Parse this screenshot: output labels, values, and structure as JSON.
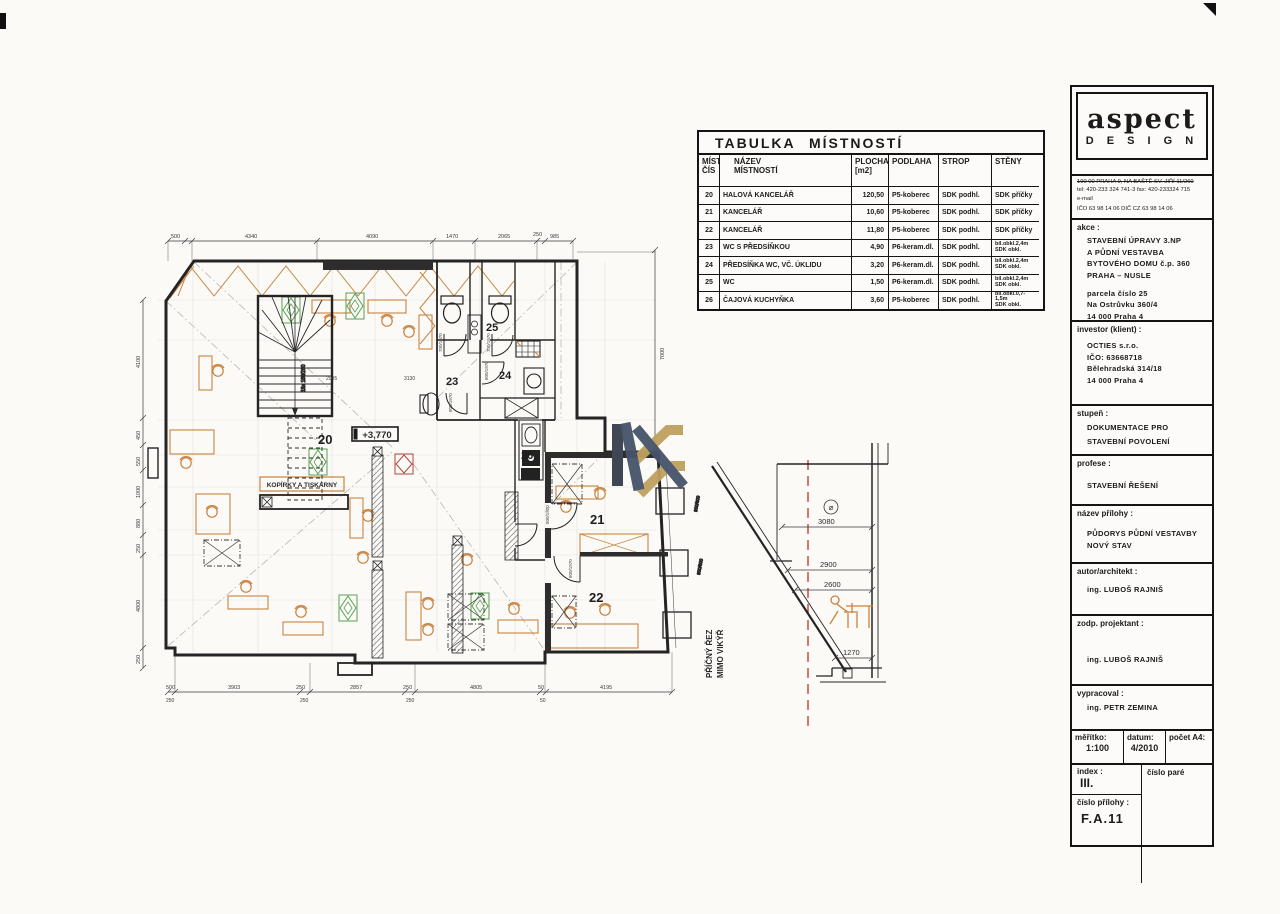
{
  "floor_plan": {
    "room_numbers": {
      "r20": "20",
      "r21": "21",
      "r22": "22",
      "r23": "23",
      "r24": "24",
      "r25": "25",
      "r26": "26"
    },
    "elevation_label": "+3,770",
    "copier_label": "KOPÍRKY A TISKÁRNY",
    "stair_note": "19x 180/260",
    "door_note_700": "700/1970",
    "door_note_800": "800/1970",
    "window_note": "900/600",
    "interior_dims": {
      "d1": "2005",
      "d2": "3130"
    },
    "dims_top": [
      "500",
      "4340",
      "4090",
      "1470",
      "2065",
      "250",
      "985"
    ],
    "dims_left": [
      "4100",
      "450",
      "550",
      "1000",
      "880",
      "250",
      "4800",
      "250"
    ],
    "dims_bottom": [
      "500",
      "3903",
      "250",
      "2857",
      "250",
      "4805",
      "50",
      "4195"
    ],
    "dims_bottom_secondary": [
      "250",
      "250",
      "250",
      "50"
    ],
    "dims_right": [
      "7000"
    ]
  },
  "section": {
    "label_line1": "PŘÍČNÝ ŘEZ",
    "label_line2": "MIMO VIKÝŘ",
    "level_circle": "⌀",
    "level_top": "3080",
    "levels": [
      "2900",
      "2600",
      "1270"
    ]
  },
  "room_table": {
    "title": "TABULKA MÍSTNOSTÍ",
    "headers": {
      "cis1": "MÍST",
      "cis2": "ČÍS",
      "nazev1": "NÁZEV",
      "nazev2": "MÍSTNOSTÍ",
      "plocha1": "PLOCHA",
      "plocha2": "[m2]",
      "podlaha": "PODLAHA",
      "strop": "STROP",
      "steny": "STĚNY"
    },
    "rows": [
      {
        "num": "20",
        "name": "HALOVÁ KANCELÁŘ",
        "area": "120,50",
        "floor": "P5-koberec",
        "ceiling": "SDK podhl.",
        "walls1": "SDK příčky",
        "walls2": ""
      },
      {
        "num": "21",
        "name": "KANCELÁŘ",
        "area": "10,60",
        "floor": "P5-koberec",
        "ceiling": "SDK podhl.",
        "walls1": "SDK příčky",
        "walls2": ""
      },
      {
        "num": "22",
        "name": "KANCELÁŘ",
        "area": "11,80",
        "floor": "P5-koberec",
        "ceiling": "SDK podhl.",
        "walls1": "SDK příčky",
        "walls2": ""
      },
      {
        "num": "23",
        "name": "WC S PŘEDSÍŇKOU",
        "area": "4,90",
        "floor": "P6-keram.dl.",
        "ceiling": "SDK podhl.",
        "walls1": "bíl.obkl.2,4m",
        "walls2": "SDK obkl."
      },
      {
        "num": "24",
        "name": "PŘEDSÍŇKA WC, VČ. ÚKLIDU",
        "area": "3,20",
        "floor": "P6-keram.dl.",
        "ceiling": "SDK podhl.",
        "walls1": "bíl.obkl.2,4m",
        "walls2": "SDK obkl."
      },
      {
        "num": "25",
        "name": "WC",
        "area": "1,50",
        "floor": "P6-keram.dl.",
        "ceiling": "SDK podhl.",
        "walls1": "bíl.obkl.2,4m",
        "walls2": "SDK obkl."
      },
      {
        "num": "26",
        "name": "ČAJOVÁ KUCHYŇKA",
        "area": "3,60",
        "floor": "P5-koberec",
        "ceiling": "SDK podhl.",
        "walls1": "bíl.obkl.0,7-1,5m",
        "walls2": "SDK obkl."
      }
    ]
  },
  "title_block": {
    "logo_name": "aspect",
    "logo_sub": "D E S I G N",
    "address_line": "190 00  PRAHA 9, NA BAŠTĚ SV. JIŘÍ 11/260",
    "phone_line": "tel: 420-233 324 741-3    fax: 420-233324 715",
    "email_line": "e-mail",
    "reg_line": "IČO  63 98 14 06    DIČ CZ 63 98 14 06",
    "akce_label": "akce :",
    "akce_lines": [
      "STAVEBNÍ ÚPRAVY 3.NP",
      "A PŮDNÍ VESTAVBA",
      "BYTOVÉHO DOMU č.p. 360",
      "PRAHA  –  NUSLE"
    ],
    "akce_lines2": [
      "parcela číslo 25",
      "Na Ostrůvku 360/4",
      "14 000 Praha 4"
    ],
    "investor_label": "investor (klient) :",
    "investor_lines": [
      "OCTIES  s.r.o.",
      "IČO:  63668718",
      "Bělehradská  314/18",
      "14 000 Praha 4"
    ],
    "stupen_label": "stupeň :",
    "stupen_lines": [
      "DOKUMENTACE PRO",
      "STAVEBNÍ POVOLENÍ"
    ],
    "profese_label": "profese :",
    "profese_value": "STAVEBNÍ ŘEŠENÍ",
    "nazev_label": "název přílohy :",
    "nazev_lines": [
      "PŮDORYS PŮDNÍ VESTAVBY",
      "NOVÝ STAV"
    ],
    "autor_label": "autor/architekt :",
    "autor_value": "ing. LUBOŠ RAJNIŠ",
    "zodp_label": "zodp. projektant :",
    "zodp_value": "ing. LUBOŠ RAJNIŠ",
    "vypracoval_label": "vypracoval :",
    "vypracoval_value": "ing. PETR ZEMINA",
    "meritko_label": "měřítko:",
    "meritko_value": "1:100",
    "datum_label": "datum:",
    "datum_value": "4/2010",
    "pocet_label": "počet A4:",
    "index_label": "index :",
    "index_value": "III.",
    "pare_label": "číslo paré",
    "cislo_label": "číslo přílohy :",
    "cislo_value": "F.A.11"
  },
  "colors": {
    "accent_orange": "#c9823f",
    "plant_green": "#58a055",
    "watermark_gold": "#bfa05f",
    "watermark_slate": "#46536a",
    "section_axis_red": "#c0443a"
  }
}
